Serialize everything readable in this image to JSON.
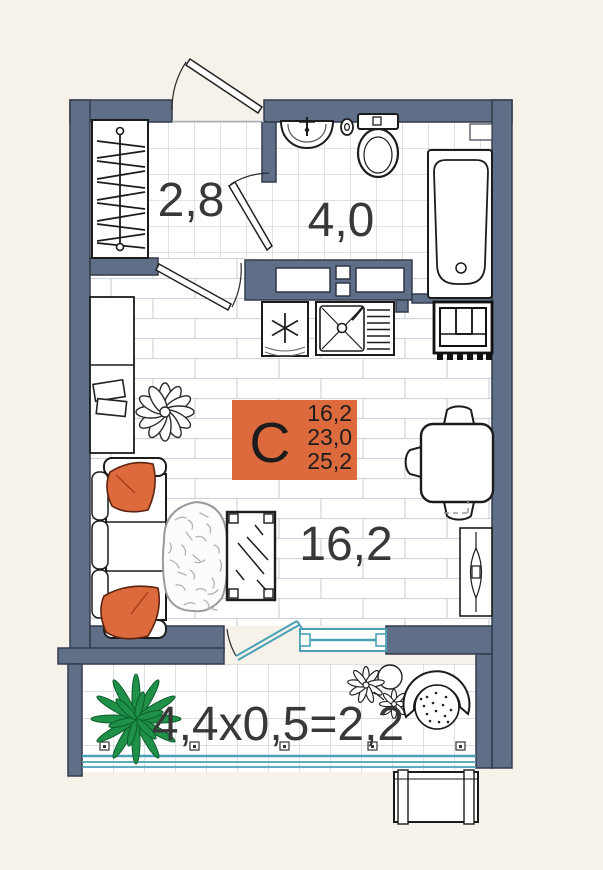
{
  "plan": {
    "type": "studio apartment floor plan",
    "rooms": {
      "hallway": {
        "area": "2,8"
      },
      "bathroom": {
        "area": "4,0"
      },
      "living_room": {
        "area": "16,2"
      },
      "balcony": {
        "formula": "4,4х0,5=2,2"
      }
    },
    "badge": {
      "letter": "С",
      "values": [
        "16,2",
        "23,0",
        "25,2"
      ]
    },
    "colors": {
      "background": "#f7f2e9",
      "wall": "#5e6f87",
      "accent_orange": "#dc6a3c",
      "window_teal": "#4aa1b5",
      "plant_green": "#1f9048",
      "label_text": "#383838"
    }
  }
}
